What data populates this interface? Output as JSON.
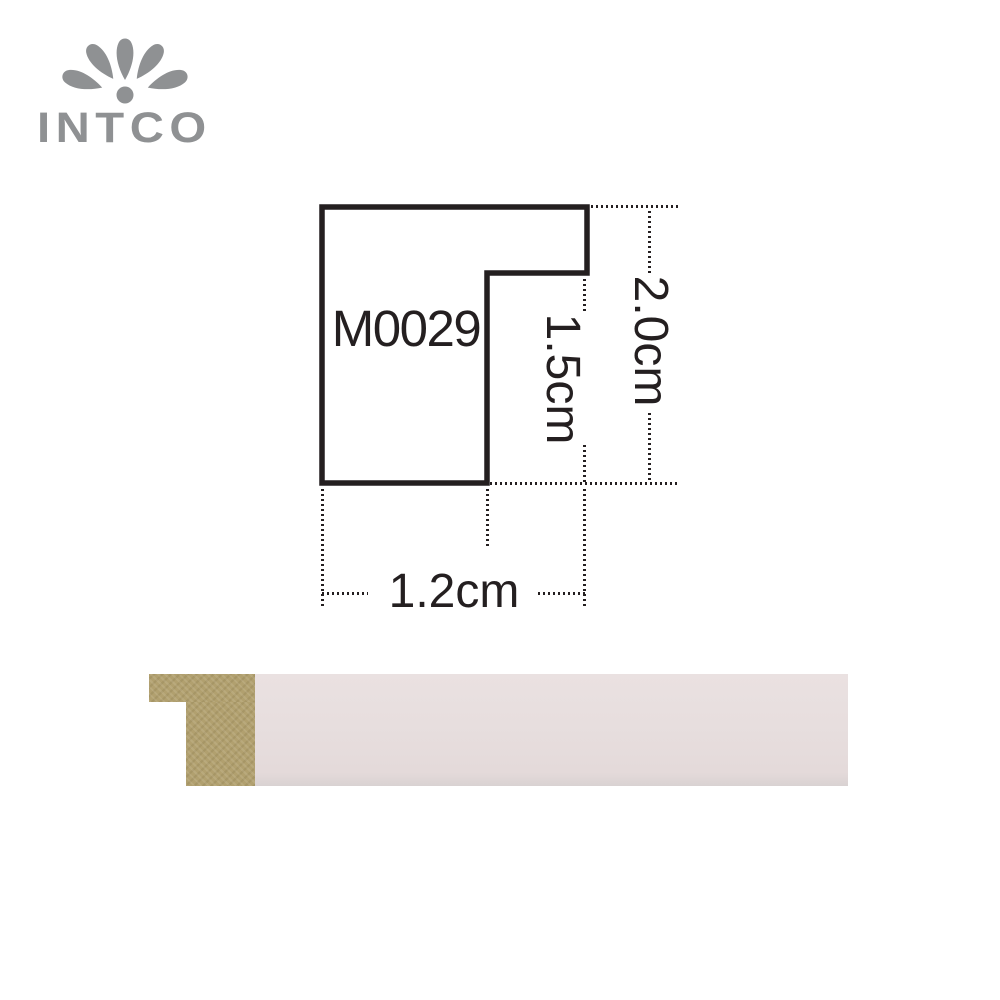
{
  "brand": {
    "name": "INTCO"
  },
  "diagram": {
    "model_code": "M0029",
    "dim_total_height": "2.0cm",
    "dim_rabbet_height": "1.5cm",
    "dim_width": "1.2cm"
  },
  "photo": {
    "core_color": "#b1a06f",
    "surface_color": "#e7dede"
  },
  "colors": {
    "line_black": "#241f20",
    "logo_gray": "#8f9193"
  }
}
